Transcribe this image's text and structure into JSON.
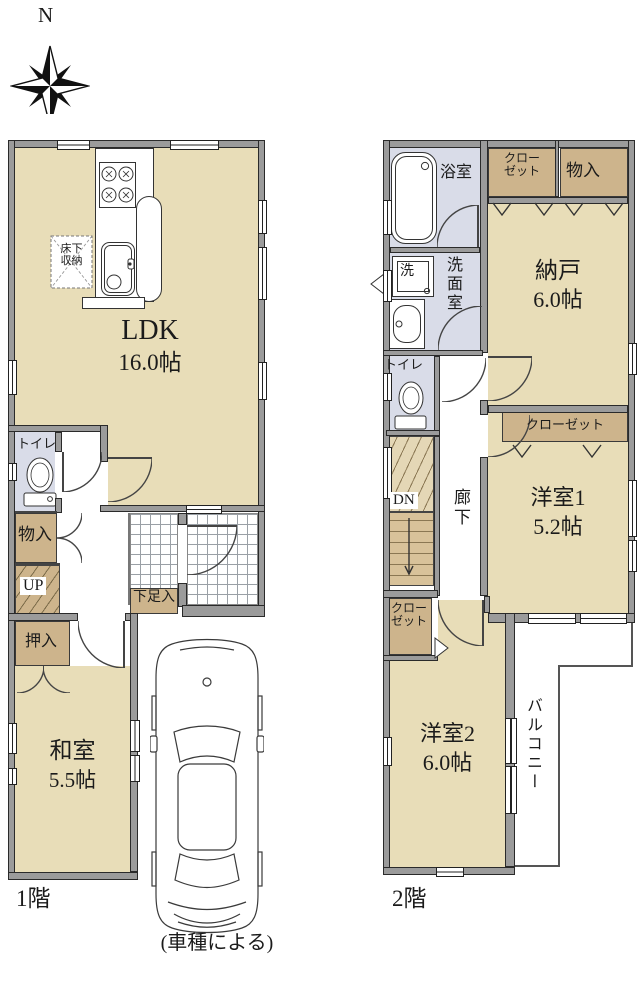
{
  "compass": {
    "north_label": "N"
  },
  "floor1": {
    "floor_label": "1階",
    "ldk": {
      "name": "LDK",
      "area": "16.0帖"
    },
    "underfloor_storage": {
      "line1": "床下",
      "line2": "収納"
    },
    "toilet": "トイレ",
    "storage": "物入",
    "stairs_up": "UP",
    "shoe_storage": "下足入",
    "oshiire": "押入",
    "washitsu": {
      "name": "和室",
      "area": "5.5帖"
    }
  },
  "floor2": {
    "floor_label": "2階",
    "bathroom": "浴室",
    "closet_a": {
      "line1": "クロー",
      "line2": "ゼット"
    },
    "storage": "物入",
    "nando": {
      "name": "納戸",
      "area": "6.0帖"
    },
    "washer": "洗",
    "washroom": "洗面室",
    "toilet": "トイレ",
    "stairs_down": "DN",
    "hallway": "廊下",
    "closet_b": "クローゼット",
    "yoshitsu1": {
      "name": "洋室1",
      "area": "5.2帖"
    },
    "closet_c": {
      "line1": "クロー",
      "line2": "ゼット"
    },
    "yoshitsu2": {
      "name": "洋室2",
      "area": "6.0帖"
    },
    "balcony": "バルコニー"
  },
  "caption": "(車種による)",
  "colors": {
    "floor_tan": "#e8ddb8",
    "closet_tan": "#cdb48c",
    "wet_blue": "#d9dce8",
    "wall_gray": "#9b9b9b",
    "stair_light": "#e4d7b6",
    "stair_dark": "#d8c29a"
  }
}
